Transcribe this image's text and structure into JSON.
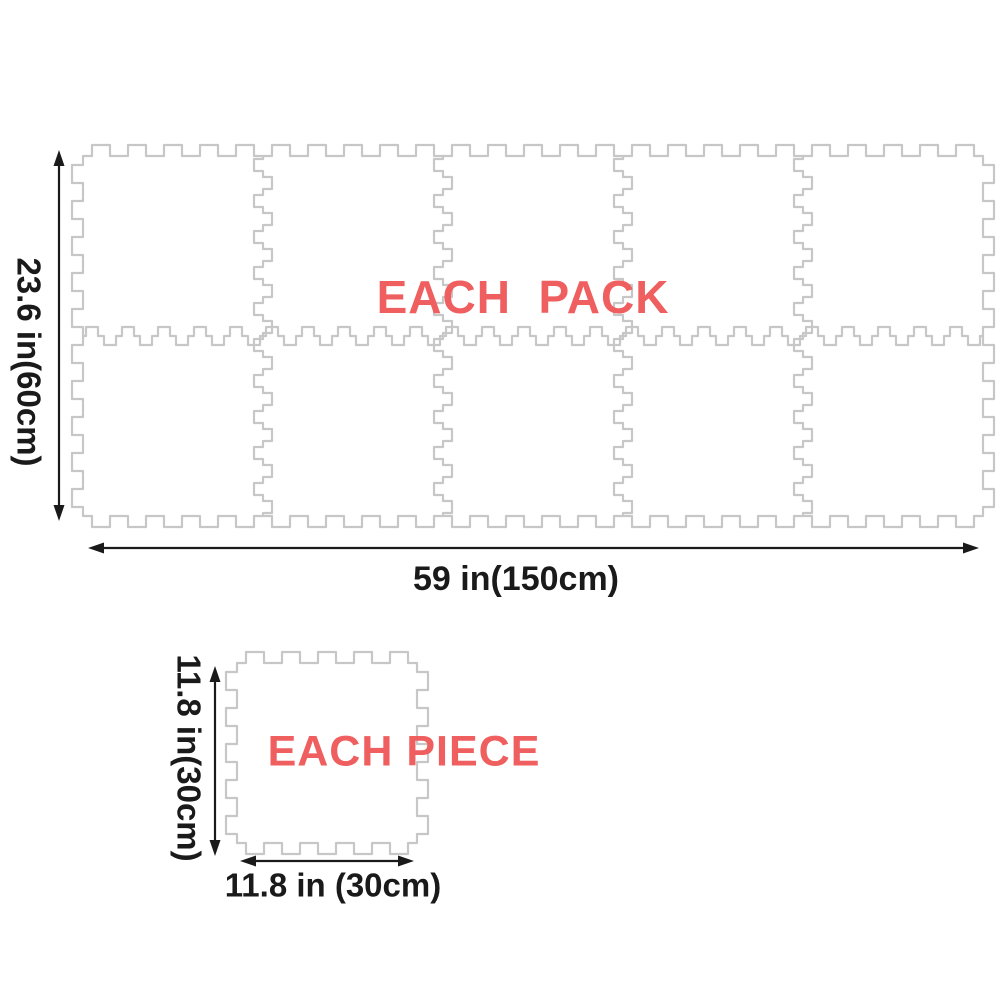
{
  "pack": {
    "label": "EACH  PACK",
    "height_label": "23.6 in(60cm)",
    "width_label": "59 in(150cm)",
    "grid": {
      "rows": 2,
      "cols": 5
    }
  },
  "piece": {
    "label": "EACH PIECE",
    "height_label": "11.8 in(30cm)",
    "width_label": "11.8 in (30cm)"
  },
  "colors": {
    "accent": "#ef5f5f",
    "outline": "#c7c7c7",
    "dimension": "#1a1a1a",
    "background": "#ffffff"
  }
}
